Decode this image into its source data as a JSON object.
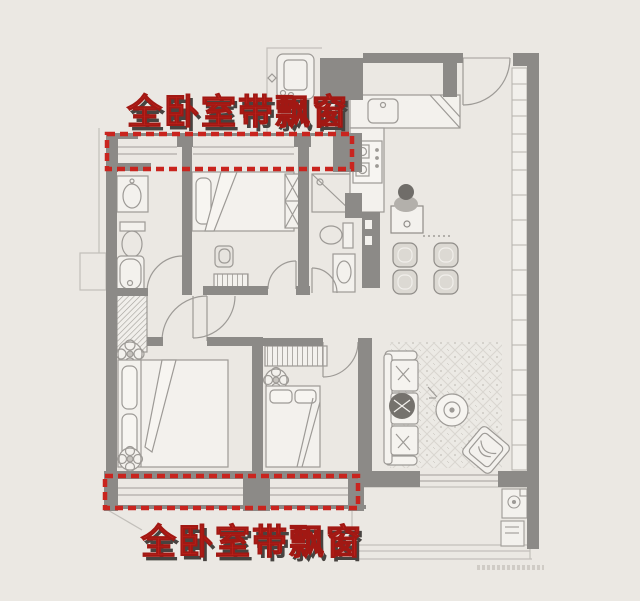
{
  "annotations": {
    "top_label": "全卧室带飘窗",
    "bottom_label": "全卧室带飘窗"
  },
  "colors": {
    "background": "#ebe8e3",
    "wall": "#8c8a87",
    "accent_red": "#c9241e",
    "label_shadow": "#474340",
    "furniture_line": "#9d9a96",
    "window_line": "#b9b6b1",
    "rug_line": "#d9d6d0"
  }
}
